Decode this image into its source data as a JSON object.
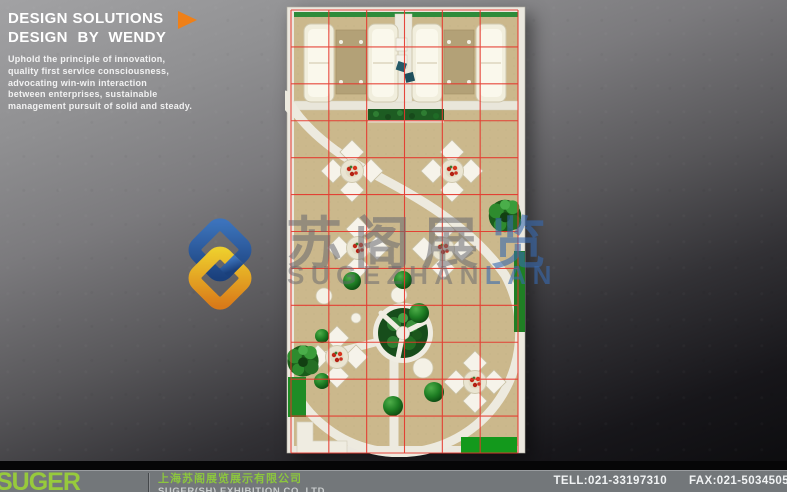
{
  "header": {
    "title_line1": "DESIGN SOLUTIONS",
    "title_line2": "DESIGN BY WENDY",
    "description_lines": [
      "Uphold the principle of innovation,",
      "quality first service consciousness,",
      "advocating win-win interaction",
      "between enterprises, sustainable",
      "management pursuit of solid and steady."
    ]
  },
  "watermark": {
    "cn_gray": "苏阁展",
    "cn_blue": "览",
    "en_gray": "SUGEZHAN",
    "en_blue": "LAN"
  },
  "floor_plan": {
    "label": "exhibition booth floor plan, top view",
    "grid_color": "#e5352b",
    "grid_cols": 6,
    "grid_rows": 12,
    "floor_color": "#cbb88c",
    "wall_color": "#ebe8df",
    "greenery_color": "#1d5c22"
  },
  "footer": {
    "brand": "SUGER",
    "company_cn": "上海苏阁展览展示有限公司",
    "company_en": "SUGER(SH) EXHIBITION CO.,LTD",
    "tel": "TELL:021-33197310",
    "fax": "FAX:021-5034505"
  },
  "colors": {
    "accent_orange": "#ef8018",
    "brand_green": "#8cc63e",
    "logo_blue": "#2a5ea8",
    "logo_yellow": "#f0c42a",
    "grid_red": "#e5352b"
  }
}
